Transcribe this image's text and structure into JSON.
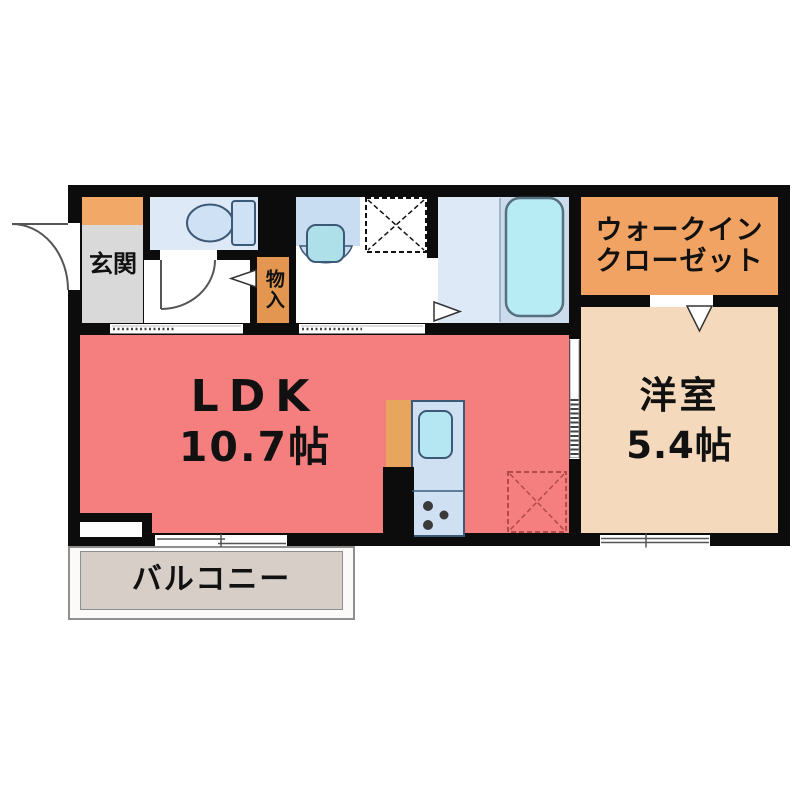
{
  "floor_plan": {
    "rooms": {
      "entrance": {
        "label": "玄関"
      },
      "storage": {
        "label": "物入"
      },
      "walk_in_closet": {
        "line1": "ウォークイン",
        "line2": "クローゼット"
      },
      "ldk": {
        "label": "LDK",
        "size": "10.7帖"
      },
      "western_room": {
        "label": "洋室",
        "size": "5.4帖"
      },
      "balcony": {
        "label": "バルコニー"
      }
    },
    "fixtures": [
      "toilet-icon",
      "washbasin-icon",
      "bathtub-icon",
      "kitchen-sink-icon",
      "stove-burners-icon",
      "washing-machine-space-icon",
      "refrigerator-space-icon",
      "entrance-door-arc",
      "toilet-door-arc",
      "sliding-door-symbols",
      "door-swing-markers"
    ],
    "colors": {
      "wall": "#0c0c0c",
      "ldk": "#f57f7f",
      "western": "#f4d9bc",
      "closet": "#f1a363",
      "storage": "#e2964f",
      "entrance": "#d9d9d9",
      "cabinet": "#f2a867",
      "wetfloor": "#dde9f6",
      "bathright": "#ccdcec",
      "fixture": "#cfe2f5",
      "basin": "#aee0ea",
      "tub": "#b8ecf4",
      "kitchenunit": "#cfe0f3",
      "counter": "#e8a55e",
      "balconyfloor": "#d6cec7",
      "outline": "#3c5a78",
      "fridgedash": "#b24a4a"
    }
  }
}
